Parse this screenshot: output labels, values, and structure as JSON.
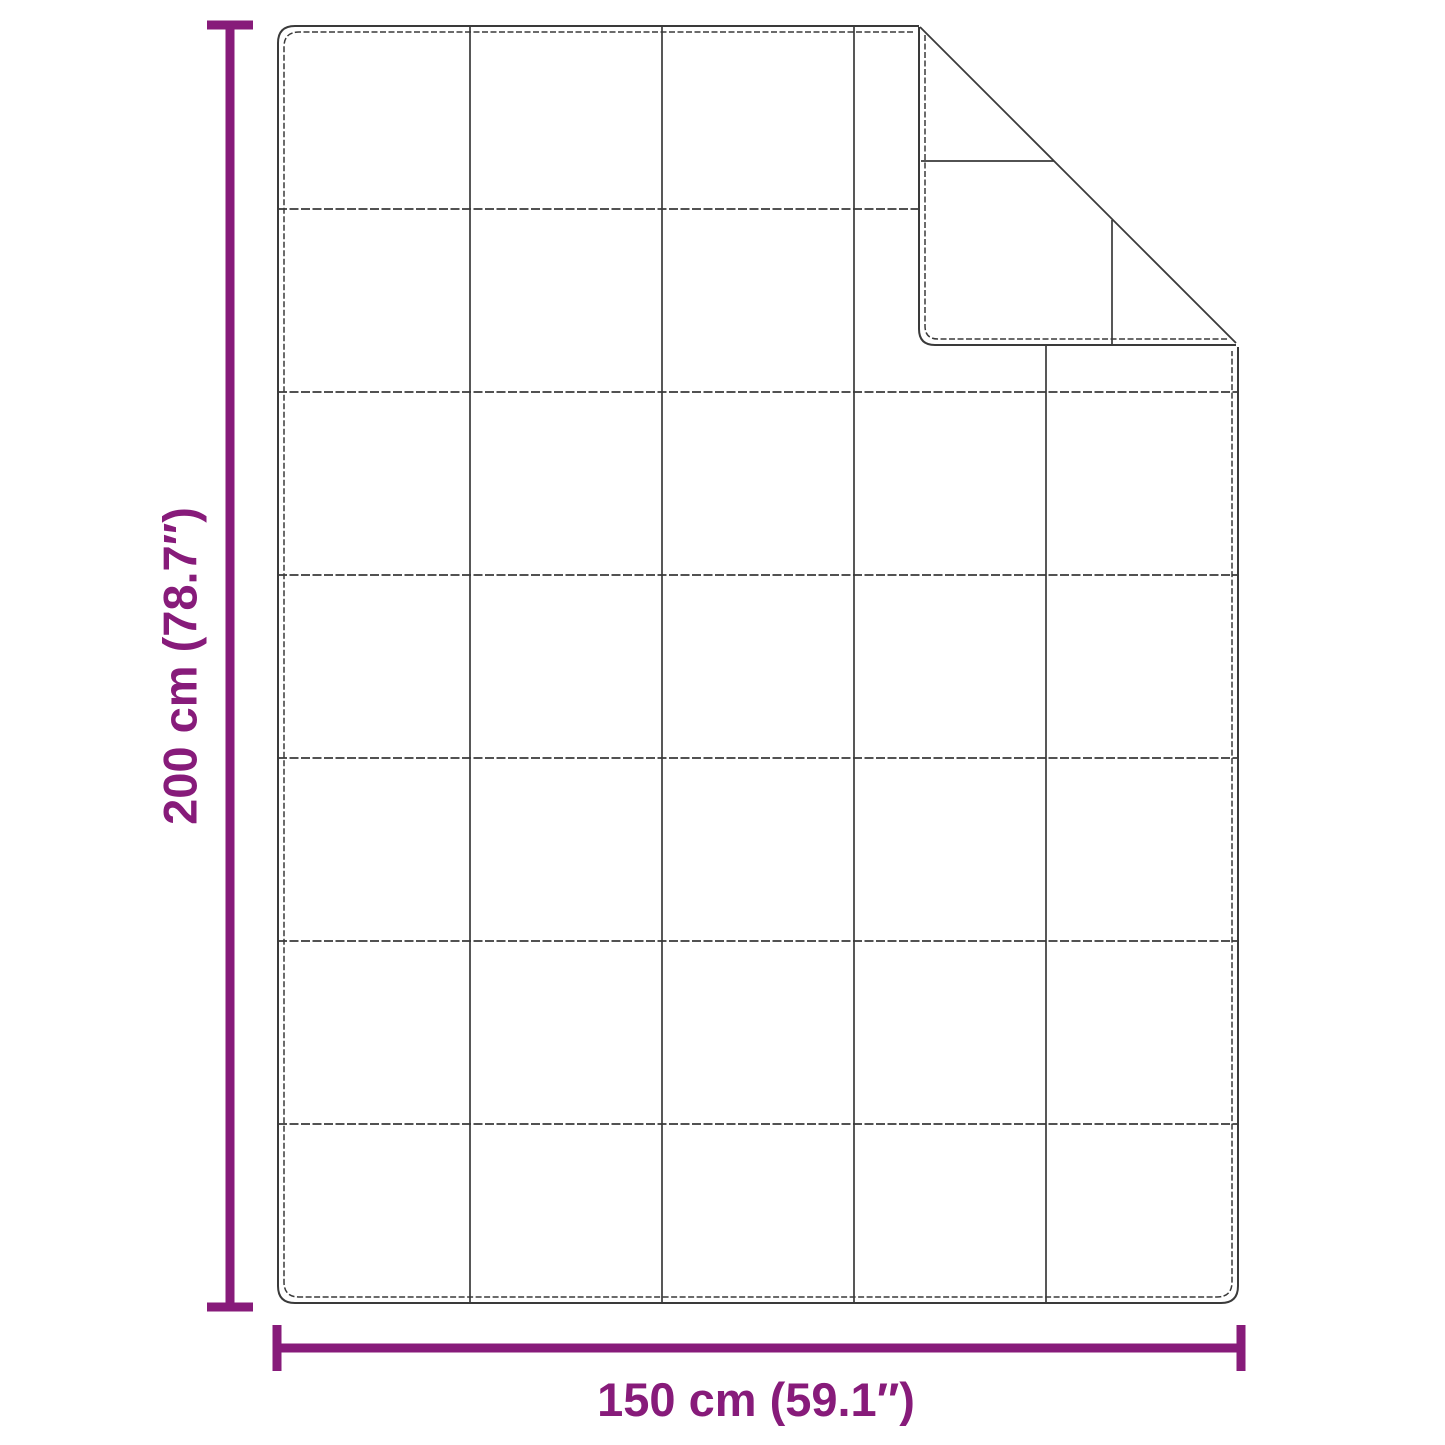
{
  "diagram": {
    "name": "blanket-dimension-diagram",
    "subject": "quilted blanket top view with folded corner",
    "height_label": "200 cm (78.7″)",
    "width_label": "150 cm (59.1″)",
    "grid": {
      "columns": 5,
      "rows": 7
    },
    "colors": {
      "accent": "#871b7a",
      "line": "#3a3a3a",
      "background": "#ffffff"
    }
  }
}
